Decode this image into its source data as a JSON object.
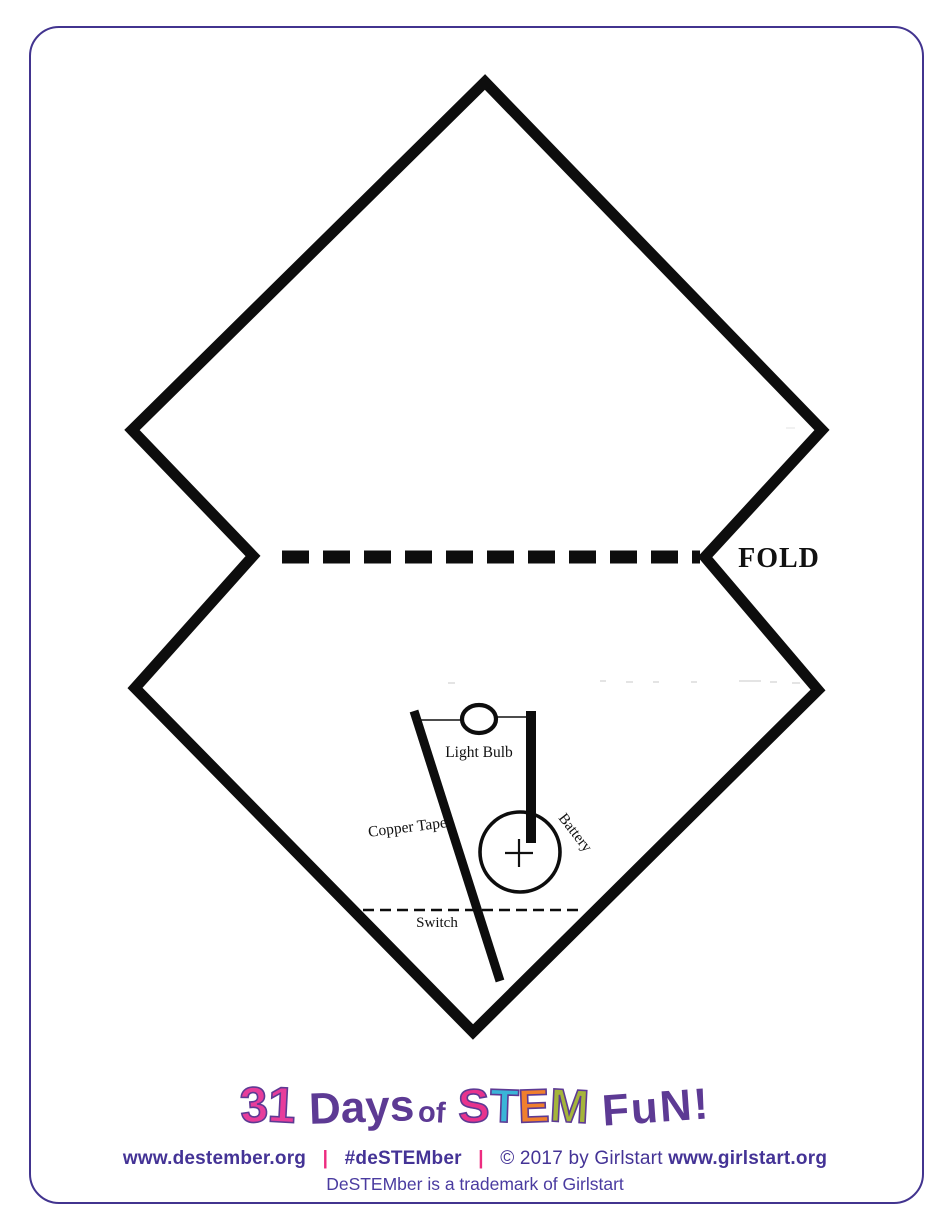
{
  "page": {
    "background": "#ffffff",
    "frame_color": "#42348f",
    "ink_color": "#0d0d0d"
  },
  "fold": {
    "label": "FOLD"
  },
  "circuit": {
    "light_bulb_label": "Light Bulb",
    "copper_tape_label": "Copper Tape",
    "battery_label": "Battery",
    "battery_polarity": "+",
    "switch_label": "Switch"
  },
  "footer": {
    "logo": {
      "parts": [
        {
          "text": "3",
          "color": "#e73d9b"
        },
        {
          "text": "1",
          "color": "#e73d9b"
        },
        {
          "text": "Days",
          "color": "#5d3a94"
        },
        {
          "text": "of",
          "color": "#5d3a94"
        },
        {
          "text": "S",
          "color": "#e8338d"
        },
        {
          "text": "T",
          "color": "#3ab5d8"
        },
        {
          "text": "E",
          "color": "#f07f2e"
        },
        {
          "text": "M",
          "color": "#a5b53a"
        },
        {
          "text": "FuN!",
          "color": "#5d3a94"
        }
      ]
    },
    "links_line": {
      "destember_url": "www.destember.org",
      "separator": "|",
      "separator_color": "#ed2c80",
      "hashtag": "#deSTEMber",
      "copyright": "© 2017 by Girlstart",
      "girlstart_url": "www.girlstart.org",
      "text_color": "#443396"
    },
    "trademark": "DeSTEMber is a trademark of Girlstart"
  }
}
